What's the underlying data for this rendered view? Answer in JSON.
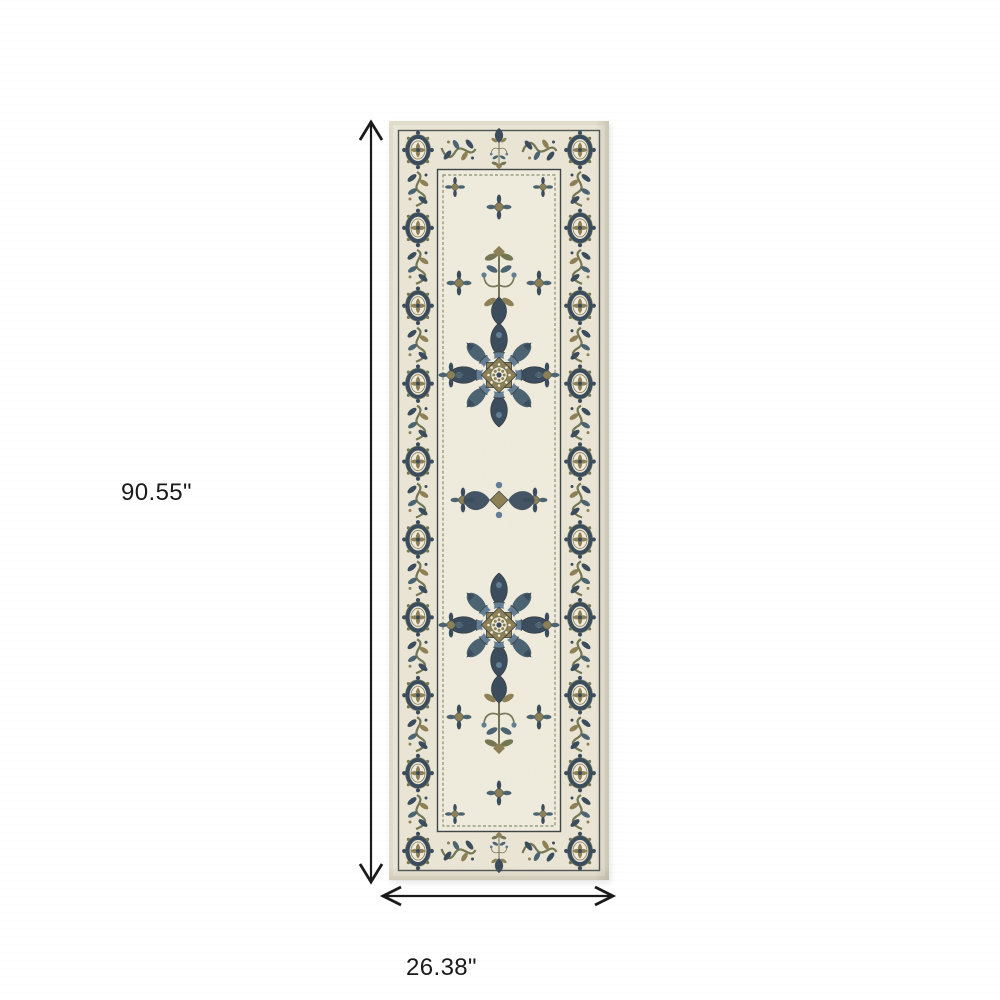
{
  "annotations": {
    "height_label": "90.55\"",
    "width_label": "26.38\""
  },
  "arrow_color": "#1a1a1a",
  "page_background": "#ffffff",
  "rug_palette": {
    "cream": "#ECE7D7",
    "cream_light": "#F2EEE0",
    "edge": "#E3DECC",
    "navy": "#35485A",
    "navy_dark": "#2B3844",
    "steel": "#5F7B93",
    "slate": "#47606F",
    "olive": "#8C7E52",
    "sage": "#70744F",
    "charcoal": "#2F3839"
  }
}
